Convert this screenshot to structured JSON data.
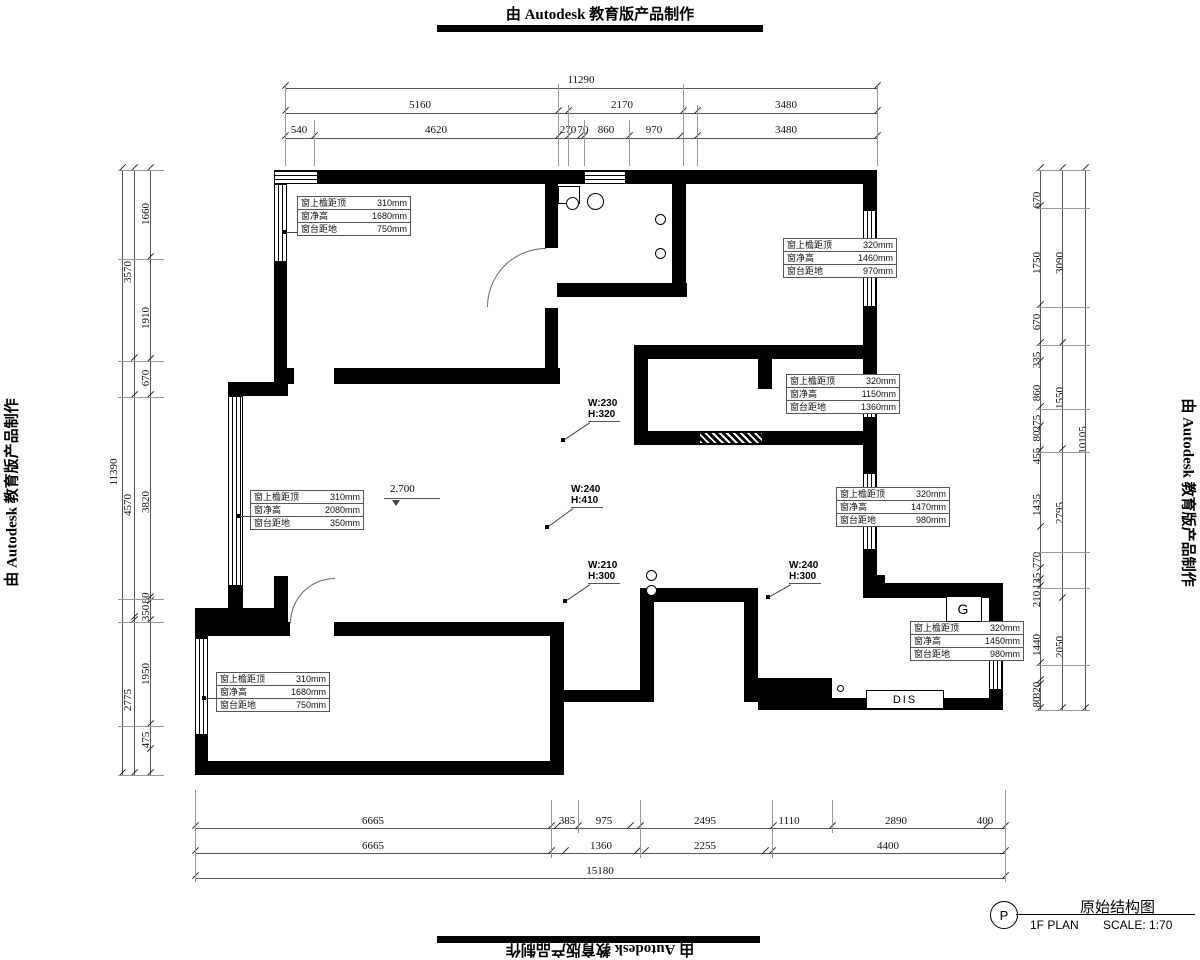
{
  "watermarks": {
    "top": "由 Autodesk 教育版产品制作",
    "bottom": "由 Autodesk 教育版产品制作",
    "left": "由 Autodesk 教育版产品制作",
    "right": "由 Autodesk 教育版产品制作"
  },
  "title_block": {
    "symbol": "P",
    "title": "原始结构图",
    "plan": "1F PLAN",
    "scale": "SCALE: 1:70"
  },
  "level_mark": {
    "value": "2.700"
  },
  "room_labels": {
    "gas": "G",
    "dis": "DIS"
  },
  "wh_labels": [
    {
      "w": "W:230",
      "h": "H:320",
      "x": 588,
      "y": 398,
      "dx": 563,
      "dy": 440
    },
    {
      "w": "W:240",
      "h": "H:410",
      "x": 571,
      "y": 484,
      "dx": 547,
      "dy": 527
    },
    {
      "w": "W:210",
      "h": "H:300",
      "x": 588,
      "y": 560,
      "dx": 565,
      "dy": 601
    },
    {
      "w": "W:240",
      "h": "H:300",
      "x": 789,
      "y": 560,
      "dx": 768,
      "dy": 597
    }
  ],
  "window_tags": [
    {
      "x": 297,
      "y": 196,
      "leader": {
        "x1": 284,
        "x2": 297,
        "y": 232
      },
      "rows": [
        [
          "窗上檐距顶",
          "310mm"
        ],
        [
          "窗净高",
          "1680mm"
        ],
        [
          "窗台距地",
          "750mm"
        ]
      ]
    },
    {
      "x": 783,
      "y": 238,
      "leader": {
        "x1": 869,
        "x2": 895,
        "y": 264
      },
      "rows": [
        [
          "窗上檐距顶",
          "320mm"
        ],
        [
          "窗净高",
          "1460mm"
        ],
        [
          "窗台距地",
          "970mm"
        ]
      ]
    },
    {
      "x": 786,
      "y": 374,
      "leader": {
        "x1": 869,
        "x2": 898,
        "y": 400
      },
      "rows": [
        [
          "窗上檐距顶",
          "320mm"
        ],
        [
          "窗净高",
          "1150mm"
        ],
        [
          "窗台距地",
          "1360mm"
        ]
      ]
    },
    {
      "x": 250,
      "y": 490,
      "leader": {
        "x1": 238,
        "x2": 250,
        "y": 516
      },
      "rows": [
        [
          "窗上檐距顶",
          "310mm"
        ],
        [
          "窗净高",
          "2080mm"
        ],
        [
          "窗台距地",
          "350mm"
        ]
      ]
    },
    {
      "x": 836,
      "y": 487,
      "leader": {
        "x1": 869,
        "x2": 948,
        "y": 513
      },
      "rows": [
        [
          "窗上檐距顶",
          "320mm"
        ],
        [
          "窗净高",
          "1470mm"
        ],
        [
          "窗台距地",
          "980mm"
        ]
      ]
    },
    {
      "x": 216,
      "y": 672,
      "leader": {
        "x1": 204,
        "x2": 216,
        "y": 698
      },
      "rows": [
        [
          "窗上檐距顶",
          "310mm"
        ],
        [
          "窗净高",
          "1680mm"
        ],
        [
          "窗台距地",
          "750mm"
        ]
      ]
    },
    {
      "x": 910,
      "y": 621,
      "leader": {
        "x1": 995,
        "x2": 1022,
        "y": 647
      },
      "rows": [
        [
          "窗上檐距顶",
          "320mm"
        ],
        [
          "窗净高",
          "1450mm"
        ],
        [
          "窗台距地",
          "980mm"
        ]
      ]
    }
  ],
  "dimensions": {
    "labels": [
      {
        "t": "11290",
        "x": 581,
        "y": 80,
        "r": 0
      },
      {
        "t": "5160",
        "x": 420,
        "y": 105,
        "r": 0
      },
      {
        "t": "2170",
        "x": 622,
        "y": 105,
        "r": 0
      },
      {
        "t": "3480",
        "x": 786,
        "y": 105,
        "r": 0
      },
      {
        "t": "540",
        "x": 299,
        "y": 130,
        "r": 0
      },
      {
        "t": "4620",
        "x": 436,
        "y": 130,
        "r": 0
      },
      {
        "t": "270",
        "x": 568,
        "y": 130,
        "r": 0
      },
      {
        "t": "70",
        "x": 583,
        "y": 130,
        "r": 0
      },
      {
        "t": "860",
        "x": 606,
        "y": 130,
        "r": 0
      },
      {
        "t": "970",
        "x": 654,
        "y": 130,
        "r": 0
      },
      {
        "t": "3480",
        "x": 786,
        "y": 130,
        "r": 0
      },
      {
        "t": "11390",
        "x": 114,
        "y": 472,
        "r": 1
      },
      {
        "t": "3570",
        "x": 128,
        "y": 272,
        "r": 1
      },
      {
        "t": "4570",
        "x": 128,
        "y": 505,
        "r": 1
      },
      {
        "t": "2775",
        "x": 128,
        "y": 700,
        "r": 1
      },
      {
        "t": "1660",
        "x": 146,
        "y": 214,
        "r": 1
      },
      {
        "t": "1910",
        "x": 146,
        "y": 318,
        "r": 1
      },
      {
        "t": "670",
        "x": 146,
        "y": 378,
        "r": 1
      },
      {
        "t": "3820",
        "x": 146,
        "y": 502,
        "r": 1
      },
      {
        "t": "80",
        "x": 146,
        "y": 598,
        "r": 1
      },
      {
        "t": "350",
        "x": 146,
        "y": 613,
        "r": 1
      },
      {
        "t": "1950",
        "x": 146,
        "y": 674,
        "r": 1
      },
      {
        "t": "475",
        "x": 146,
        "y": 740,
        "r": 1
      },
      {
        "t": "670",
        "x": 1037,
        "y": 200,
        "r": 1
      },
      {
        "t": "1750",
        "x": 1037,
        "y": 263,
        "r": 1
      },
      {
        "t": "670",
        "x": 1037,
        "y": 322,
        "r": 1
      },
      {
        "t": "335",
        "x": 1037,
        "y": 360,
        "r": 1
      },
      {
        "t": "860",
        "x": 1037,
        "y": 393,
        "r": 1
      },
      {
        "t": "275",
        "x": 1037,
        "y": 423,
        "r": 1
      },
      {
        "t": "80",
        "x": 1037,
        "y": 436,
        "r": 1
      },
      {
        "t": "455",
        "x": 1037,
        "y": 456,
        "r": 1
      },
      {
        "t": "1435",
        "x": 1037,
        "y": 505,
        "r": 1
      },
      {
        "t": "770",
        "x": 1037,
        "y": 560,
        "r": 1
      },
      {
        "t": "135",
        "x": 1037,
        "y": 581,
        "r": 1
      },
      {
        "t": "210",
        "x": 1037,
        "y": 599,
        "r": 1
      },
      {
        "t": "1440",
        "x": 1037,
        "y": 645,
        "r": 1
      },
      {
        "t": "320",
        "x": 1037,
        "y": 690,
        "r": 1
      },
      {
        "t": "80",
        "x": 1037,
        "y": 702,
        "r": 1
      },
      {
        "t": "3090",
        "x": 1060,
        "y": 263,
        "r": 1
      },
      {
        "t": "1550",
        "x": 1060,
        "y": 398,
        "r": 1
      },
      {
        "t": "2795",
        "x": 1060,
        "y": 513,
        "r": 1
      },
      {
        "t": "2050",
        "x": 1060,
        "y": 647,
        "r": 1
      },
      {
        "t": "10105",
        "x": 1083,
        "y": 440,
        "r": 1
      },
      {
        "t": "6665",
        "x": 373,
        "y": 821,
        "r": 0
      },
      {
        "t": "385",
        "x": 567,
        "y": 821,
        "r": 0
      },
      {
        "t": "975",
        "x": 604,
        "y": 821,
        "r": 0
      },
      {
        "t": "2495",
        "x": 705,
        "y": 821,
        "r": 0
      },
      {
        "t": "1110",
        "x": 789,
        "y": 821,
        "r": 0
      },
      {
        "t": "2890",
        "x": 896,
        "y": 821,
        "r": 0
      },
      {
        "t": "400",
        "x": 985,
        "y": 821,
        "r": 0
      },
      {
        "t": "6665",
        "x": 373,
        "y": 846,
        "r": 0
      },
      {
        "t": "1360",
        "x": 601,
        "y": 846,
        "r": 0
      },
      {
        "t": "2255",
        "x": 705,
        "y": 846,
        "r": 0
      },
      {
        "t": "4400",
        "x": 888,
        "y": 846,
        "r": 0
      },
      {
        "t": "15180",
        "x": 600,
        "y": 871,
        "r": 0
      }
    ],
    "lines": [
      {
        "o": "h",
        "x": 285,
        "y": 88,
        "len": 592,
        "ticks": [
          0,
          592
        ]
      },
      {
        "o": "h",
        "x": 285,
        "y": 113,
        "len": 592,
        "ticks": [
          0,
          273,
          283,
          398,
          412,
          592
        ]
      },
      {
        "o": "h",
        "x": 285,
        "y": 138,
        "len": 592,
        "ticks": [
          0,
          29,
          273,
          283,
          295,
          299,
          344,
          395,
          412,
          592
        ]
      },
      {
        "o": "v",
        "x": 122,
        "y": 170,
        "len": 605,
        "ticks": [
          0,
          605
        ]
      },
      {
        "o": "v",
        "x": 134,
        "y": 170,
        "len": 605,
        "ticks": [
          0,
          190,
          227,
          449,
          452,
          605
        ]
      },
      {
        "o": "v",
        "x": 150,
        "y": 170,
        "len": 605,
        "ticks": [
          0,
          89,
          191,
          227,
          429,
          433,
          452,
          556,
          581,
          605
        ]
      },
      {
        "o": "v",
        "x": 1040,
        "y": 170,
        "len": 540,
        "ticks": [
          0,
          38,
          137,
          175,
          193,
          239,
          258,
          282,
          359,
          400,
          411,
          418,
          495,
          512,
          516,
          540
        ]
      },
      {
        "o": "v",
        "x": 1062,
        "y": 170,
        "len": 540,
        "ticks": [
          0,
          175,
          281,
          430,
          540
        ]
      },
      {
        "o": "v",
        "x": 1085,
        "y": 170,
        "len": 540,
        "ticks": [
          0,
          540
        ]
      },
      {
        "o": "h",
        "x": 195,
        "y": 828,
        "len": 810,
        "ticks": [
          0,
          356,
          362,
          383,
          435,
          445,
          578,
          637,
          791,
          810
        ]
      },
      {
        "o": "h",
        "x": 195,
        "y": 853,
        "len": 810,
        "ticks": [
          0,
          356,
          370,
          442,
          450,
          570,
          577,
          810
        ]
      },
      {
        "o": "h",
        "x": 195,
        "y": 878,
        "len": 810,
        "ticks": [
          0,
          810
        ]
      }
    ],
    "ext": [
      {
        "o": "v",
        "x": 285,
        "y": 84,
        "len": 82
      },
      {
        "o": "v",
        "x": 314,
        "y": 120,
        "len": 46
      },
      {
        "o": "v",
        "x": 558,
        "y": 84,
        "len": 82
      },
      {
        "o": "v",
        "x": 568,
        "y": 105,
        "len": 61
      },
      {
        "o": "v",
        "x": 584,
        "y": 120,
        "len": 46
      },
      {
        "o": "v",
        "x": 629,
        "y": 120,
        "len": 46
      },
      {
        "o": "v",
        "x": 683,
        "y": 84,
        "len": 82
      },
      {
        "o": "v",
        "x": 697,
        "y": 105,
        "len": 61
      },
      {
        "o": "v",
        "x": 877,
        "y": 84,
        "len": 82
      },
      {
        "o": "h",
        "x": 118,
        "y": 170,
        "len": 46
      },
      {
        "o": "h",
        "x": 118,
        "y": 259,
        "len": 46
      },
      {
        "o": "h",
        "x": 118,
        "y": 361,
        "len": 46
      },
      {
        "o": "h",
        "x": 118,
        "y": 397,
        "len": 46
      },
      {
        "o": "h",
        "x": 118,
        "y": 599,
        "len": 46
      },
      {
        "o": "h",
        "x": 118,
        "y": 622,
        "len": 46
      },
      {
        "o": "h",
        "x": 118,
        "y": 726,
        "len": 46
      },
      {
        "o": "h",
        "x": 118,
        "y": 775,
        "len": 46
      },
      {
        "o": "h",
        "x": 1036,
        "y": 170,
        "len": 54
      },
      {
        "o": "h",
        "x": 1036,
        "y": 208,
        "len": 54
      },
      {
        "o": "h",
        "x": 1036,
        "y": 307,
        "len": 54
      },
      {
        "o": "h",
        "x": 1036,
        "y": 345,
        "len": 54
      },
      {
        "o": "h",
        "x": 1036,
        "y": 409,
        "len": 54
      },
      {
        "o": "h",
        "x": 1036,
        "y": 452,
        "len": 54
      },
      {
        "o": "h",
        "x": 1036,
        "y": 552,
        "len": 54
      },
      {
        "o": "h",
        "x": 1036,
        "y": 588,
        "len": 54
      },
      {
        "o": "h",
        "x": 1036,
        "y": 665,
        "len": 54
      },
      {
        "o": "h",
        "x": 1036,
        "y": 710,
        "len": 54
      },
      {
        "o": "v",
        "x": 195,
        "y": 790,
        "len": 92
      },
      {
        "o": "v",
        "x": 551,
        "y": 800,
        "len": 58
      },
      {
        "o": "v",
        "x": 578,
        "y": 800,
        "len": 33
      },
      {
        "o": "v",
        "x": 640,
        "y": 800,
        "len": 58
      },
      {
        "o": "v",
        "x": 772,
        "y": 800,
        "len": 58
      },
      {
        "o": "v",
        "x": 832,
        "y": 800,
        "len": 33
      },
      {
        "o": "v",
        "x": 1005,
        "y": 790,
        "len": 92
      }
    ]
  }
}
